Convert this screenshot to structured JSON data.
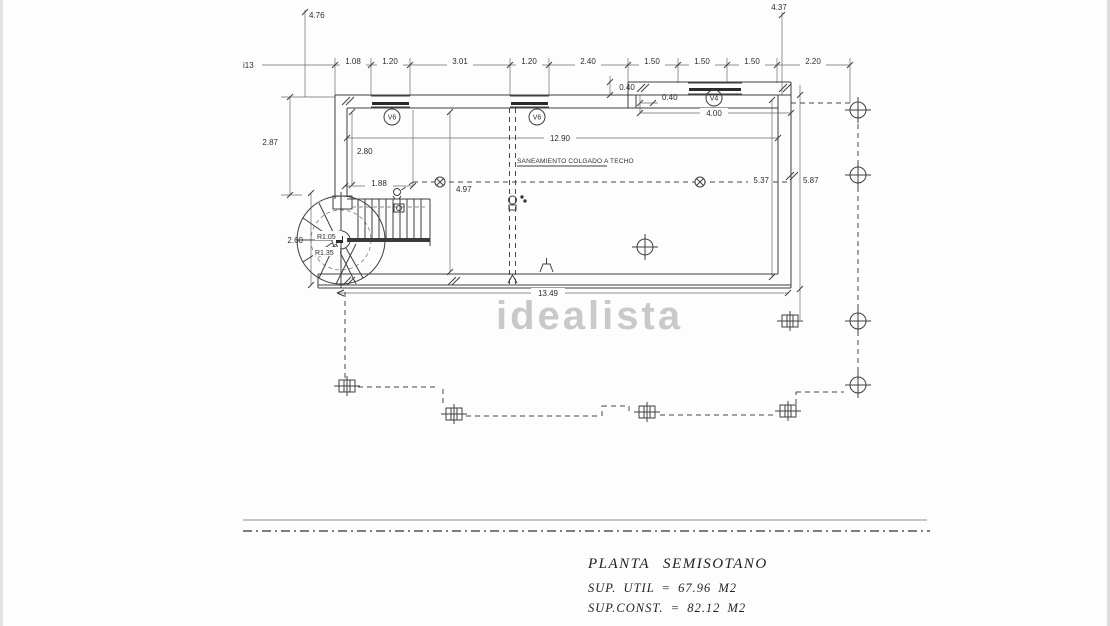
{
  "drawing": {
    "watermark": "idealista",
    "note": "SANEAMIENTO COLGADO A TECHO",
    "title_block": {
      "title": "PLANTA SEMISOTANO",
      "line1": "SUP. UTIL = 67.96 M2",
      "line2": "SUP.CONST. = 82.12 M2"
    },
    "window_labels": {
      "v6a": "V6",
      "v6b": "V6",
      "v4": "V4"
    },
    "dims": {
      "col_left_top": "4.76",
      "col_right_top": "4.37",
      "edge_left": "i13",
      "top_row": [
        "1.08",
        "1.20",
        "3.01",
        "1.20",
        "2.40",
        "1.50",
        "1.50",
        "1.50",
        "2.20"
      ],
      "step_a": "0.40",
      "step_b": "0.40",
      "porch_width": "4.00",
      "interior_width": "12.90",
      "left_outer": "2.87",
      "left_inner": "2.80",
      "stair_width": "1.88",
      "interior_depth": "4.97",
      "spiral_depth": "2.60",
      "radius_inner": "R1.05",
      "radius_outer": "R1.35",
      "right_inner": "5.37",
      "right_outer": "5.87",
      "bottom_width": "13.49"
    }
  }
}
